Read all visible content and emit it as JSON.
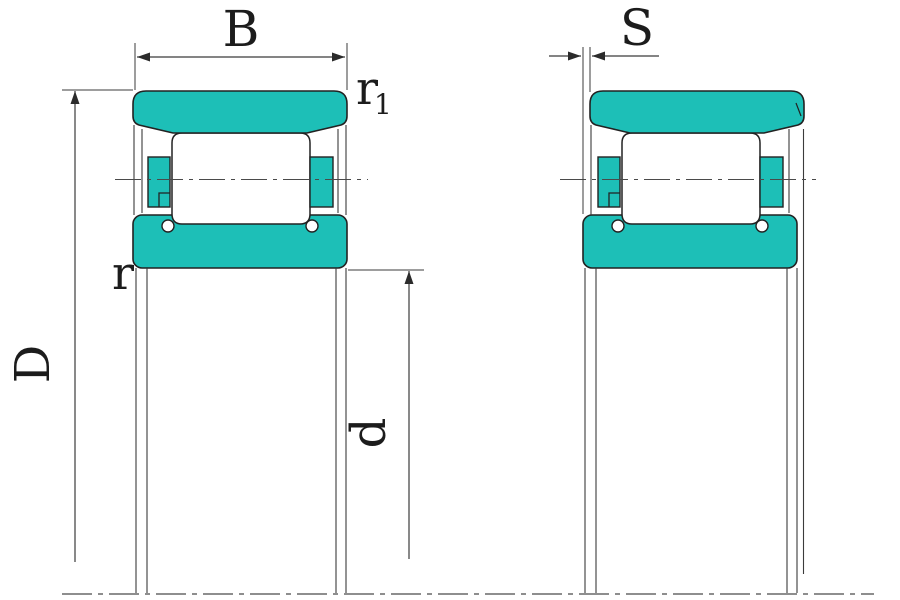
{
  "drawing": {
    "kind": "cylindrical-roller-bearing-cross-section",
    "colors": {
      "ring_fill": "#1dbfb7",
      "outline": "#222222",
      "thin_line": "#3b3b3b",
      "dimension_line": "#3b3b3b",
      "background": "#ffffff"
    },
    "left_view": {
      "labels": {
        "width": "B",
        "outer_ring_corner_radius_base": "r",
        "outer_ring_corner_radius_sub": "1",
        "inner_ring_corner_radius": "r",
        "outer_diameter": "D",
        "bore_diameter": "d"
      }
    },
    "right_view": {
      "labels": {
        "axial_displacement": "S"
      }
    }
  }
}
